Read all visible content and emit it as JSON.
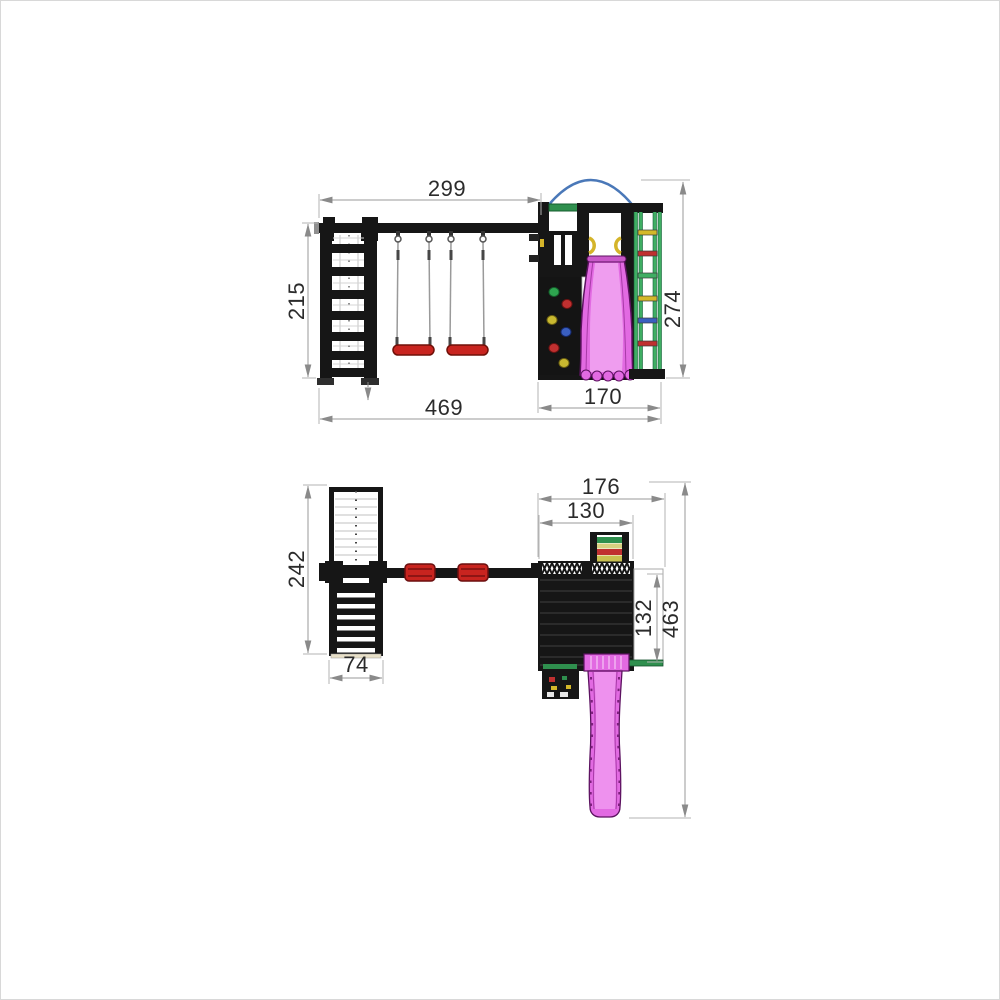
{
  "front_view": {
    "dims": {
      "beam_span": "299",
      "aframe_height": "215",
      "tower_height": "274",
      "overall_width": "469",
      "tower_width": "170"
    }
  },
  "plan_view": {
    "dims": {
      "aframe_length": "242",
      "aframe_width": "74",
      "tower_overall_width": "176",
      "tower_width": "130",
      "platform_depth": "132",
      "overall_depth": "463"
    }
  },
  "colors": {
    "structure_black": "#161616",
    "slide_pink": "#e26ae2",
    "slide_pink_light": "#f0a4f0",
    "slide_outline": "#5c1260",
    "seat_red": "#c8241f",
    "accent_green": "#2f8f4e",
    "arc_blue": "#4a78b8",
    "ladder_rail_green": "#3fae63",
    "rung_yellow": "#d4b82a",
    "rung_red": "#c03030",
    "rung_blue": "#3a5fc0",
    "dimension_line_gray": "#9a9a9a"
  }
}
